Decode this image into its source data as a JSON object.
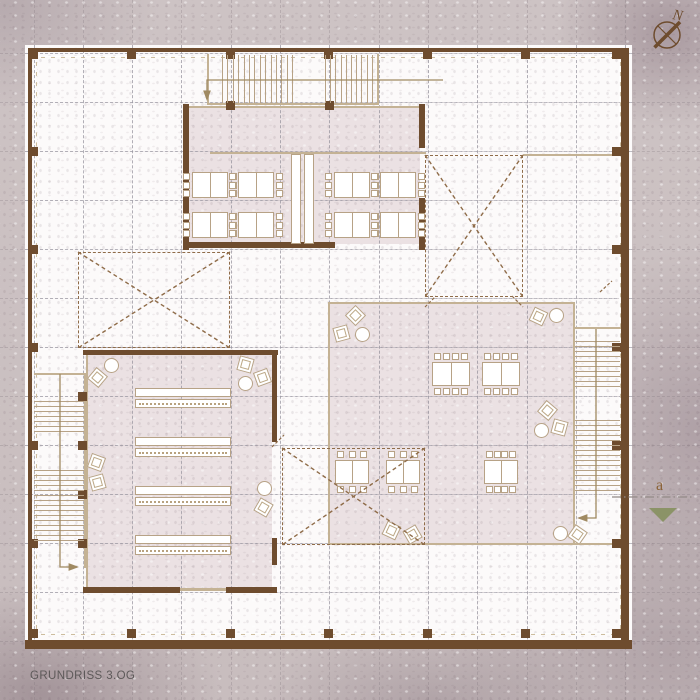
{
  "page": {
    "title": "GRUNDRISS 3.OG"
  },
  "compass": {
    "label": "N"
  },
  "section_marker": {
    "label": "a"
  },
  "colors": {
    "wall": "#6e4c2e",
    "tan": "#a08a62",
    "tanlight": "#c4b294",
    "tread": "#b7a286",
    "pink": "#ebe1e3",
    "void_dash": "#8f6c49",
    "olive": "#8b9367",
    "title_text": "#5d5959",
    "section_text": "#8a6134",
    "background": "#cdc3c4",
    "paper": "#fcfafa"
  },
  "plan": {
    "grid": {
      "x0": 33.5,
      "y0": 53,
      "step_x": 49.3,
      "step_y": 49,
      "count": 13
    },
    "rooms": [
      [
        188,
        108,
        232,
        136
      ],
      [
        88,
        354,
        184,
        234
      ],
      [
        330,
        304,
        243,
        240
      ]
    ],
    "walls": [
      [
        28,
        48,
        601,
        4
      ],
      [
        28,
        48,
        4,
        600
      ],
      [
        25,
        640,
        607,
        9
      ],
      [
        621,
        48,
        8,
        601
      ],
      [
        183,
        104,
        6,
        146
      ],
      [
        419,
        104,
        6,
        44
      ],
      [
        419,
        198,
        6,
        52
      ],
      [
        183,
        242,
        152,
        6
      ],
      [
        83,
        350,
        195,
        5
      ],
      [
        272,
        350,
        5,
        92
      ],
      [
        272,
        538,
        5,
        27
      ],
      [
        83,
        587,
        97,
        6
      ],
      [
        226,
        587,
        51,
        6
      ]
    ],
    "tan_lines": [
      [
        189,
        106,
        230,
        2
      ],
      [
        210,
        152,
        216,
        2
      ],
      [
        523,
        154,
        100,
        2
      ],
      [
        86,
        352,
        2,
        238
      ],
      [
        179,
        588,
        48,
        3
      ],
      [
        328,
        302,
        247,
        2
      ],
      [
        328,
        302,
        2,
        243
      ],
      [
        573,
        302,
        2,
        243
      ],
      [
        328,
        543,
        292,
        2
      ],
      [
        207,
        54,
        2,
        50
      ],
      [
        377,
        54,
        2,
        50
      ],
      [
        207,
        103,
        172,
        2
      ],
      [
        84,
        373,
        2,
        195
      ],
      [
        34,
        373,
        51,
        2
      ],
      [
        573,
        327,
        2,
        192
      ],
      [
        573,
        327,
        48,
        2
      ]
    ],
    "columns": [
      [
        29,
        50
      ],
      [
        127,
        50
      ],
      [
        226,
        50
      ],
      [
        324,
        50
      ],
      [
        423,
        50
      ],
      [
        521,
        50
      ],
      [
        612,
        50
      ],
      [
        29,
        629
      ],
      [
        127,
        629
      ],
      [
        226,
        629
      ],
      [
        324,
        629
      ],
      [
        423,
        629
      ],
      [
        521,
        629
      ],
      [
        612,
        629
      ],
      [
        29,
        147
      ],
      [
        29,
        245
      ],
      [
        29,
        343
      ],
      [
        29,
        441
      ],
      [
        29,
        539
      ],
      [
        612,
        147
      ],
      [
        612,
        245
      ],
      [
        612,
        343
      ],
      [
        612,
        441
      ],
      [
        612,
        539
      ],
      [
        226,
        101
      ],
      [
        325,
        101
      ],
      [
        78,
        392
      ],
      [
        78,
        441
      ],
      [
        78,
        490
      ],
      [
        78,
        539
      ]
    ],
    "voids": [
      [
        425,
        155,
        98,
        142
      ],
      [
        78,
        252,
        152,
        96
      ],
      [
        282,
        448,
        143,
        97
      ]
    ],
    "stairs": [
      {
        "o": "v",
        "x0": 222,
        "x1": 297,
        "y": 55,
        "len": 48,
        "step": 5.4
      },
      {
        "o": "v",
        "x0": 325,
        "x1": 376,
        "y": 55,
        "len": 48,
        "step": 5.2
      },
      {
        "o": "h",
        "y0": 401,
        "y1": 433,
        "x": 34,
        "len": 50,
        "step": 5
      },
      {
        "o": "h",
        "y0": 470,
        "y1": 540,
        "x": 34,
        "len": 50,
        "step": 5
      },
      {
        "o": "h",
        "y0": 341,
        "y1": 386,
        "x": 575,
        "len": 45,
        "step": 5
      },
      {
        "o": "h",
        "y0": 420,
        "y1": 490,
        "x": 575,
        "len": 45,
        "step": 5
      }
    ],
    "divider_panels": [
      [
        291,
        154,
        10,
        90
      ],
      [
        304,
        154,
        10,
        90
      ]
    ],
    "tables": [
      {
        "x": 192,
        "y": 172,
        "w": 36,
        "h": 26,
        "sides": "lr",
        "n": 3
      },
      {
        "x": 238,
        "y": 172,
        "w": 36,
        "h": 26,
        "sides": "lr",
        "n": 3
      },
      {
        "x": 334,
        "y": 172,
        "w": 36,
        "h": 26,
        "sides": "lr",
        "n": 3
      },
      {
        "x": 380,
        "y": 172,
        "w": 36,
        "h": 26,
        "sides": "lr",
        "n": 3
      },
      {
        "x": 192,
        "y": 212,
        "w": 36,
        "h": 26,
        "sides": "lr",
        "n": 3
      },
      {
        "x": 238,
        "y": 212,
        "w": 36,
        "h": 26,
        "sides": "lr",
        "n": 3
      },
      {
        "x": 334,
        "y": 212,
        "w": 36,
        "h": 26,
        "sides": "lr",
        "n": 3
      },
      {
        "x": 380,
        "y": 212,
        "w": 36,
        "h": 26,
        "sides": "lr",
        "n": 3
      },
      {
        "x": 432,
        "y": 362,
        "w": 38,
        "h": 24,
        "sides": "tb",
        "n": 4
      },
      {
        "x": 482,
        "y": 362,
        "w": 38,
        "h": 24,
        "sides": "tb",
        "n": 4
      },
      {
        "x": 335,
        "y": 460,
        "w": 34,
        "h": 24,
        "sides": "tb",
        "n": 3
      },
      {
        "x": 386,
        "y": 460,
        "w": 34,
        "h": 24,
        "sides": "tb",
        "n": 3
      },
      {
        "x": 484,
        "y": 460,
        "w": 34,
        "h": 24,
        "sides": "tb",
        "n": 4
      }
    ],
    "lecture_rows": [
      {
        "x": 135,
        "y": 388,
        "w": 96
      },
      {
        "x": 135,
        "y": 437,
        "w": 96
      },
      {
        "x": 135,
        "y": 486,
        "w": 96
      },
      {
        "x": 135,
        "y": 535,
        "w": 96
      }
    ],
    "lounge_circles": [
      [
        111,
        365
      ],
      [
        245,
        383
      ],
      [
        264,
        488
      ],
      [
        362,
        334
      ],
      [
        556,
        315
      ],
      [
        541,
        430
      ],
      [
        560,
        533
      ]
    ],
    "lounge_squares": [
      [
        97,
        377,
        40
      ],
      [
        245,
        364,
        15
      ],
      [
        262,
        377,
        -20
      ],
      [
        96,
        462,
        20
      ],
      [
        97,
        482,
        -15
      ],
      [
        263,
        507,
        30
      ],
      [
        355,
        315,
        45
      ],
      [
        341,
        333,
        -15
      ],
      [
        538,
        316,
        25
      ],
      [
        547,
        410,
        40
      ],
      [
        559,
        427,
        15
      ],
      [
        391,
        530,
        25
      ],
      [
        412,
        534,
        -30
      ],
      [
        577,
        534,
        35
      ]
    ],
    "walk_lines": [
      {
        "pts": [
          [
            443,
            80
          ],
          [
            207,
            80
          ],
          [
            207,
            99
          ]
        ]
      },
      {
        "pts": [
          [
            60,
            374
          ],
          [
            60,
            567
          ],
          [
            77,
            567
          ]
        ]
      },
      {
        "pts": [
          [
            596,
            329
          ],
          [
            596,
            518
          ],
          [
            579,
            518
          ]
        ]
      }
    ],
    "door_ticks": [
      [
        [
          425,
          307
        ],
        [
          436,
          296
        ]
      ],
      [
        [
          512,
          296
        ],
        [
          523,
          307
        ]
      ],
      [
        [
          272,
          447
        ],
        [
          284,
          435
        ]
      ],
      [
        [
          600,
          292
        ],
        [
          612,
          281
        ]
      ]
    ],
    "section_line": {
      "pts": [
        [
          612,
          497
        ],
        [
          693,
          497
        ]
      ]
    }
  }
}
